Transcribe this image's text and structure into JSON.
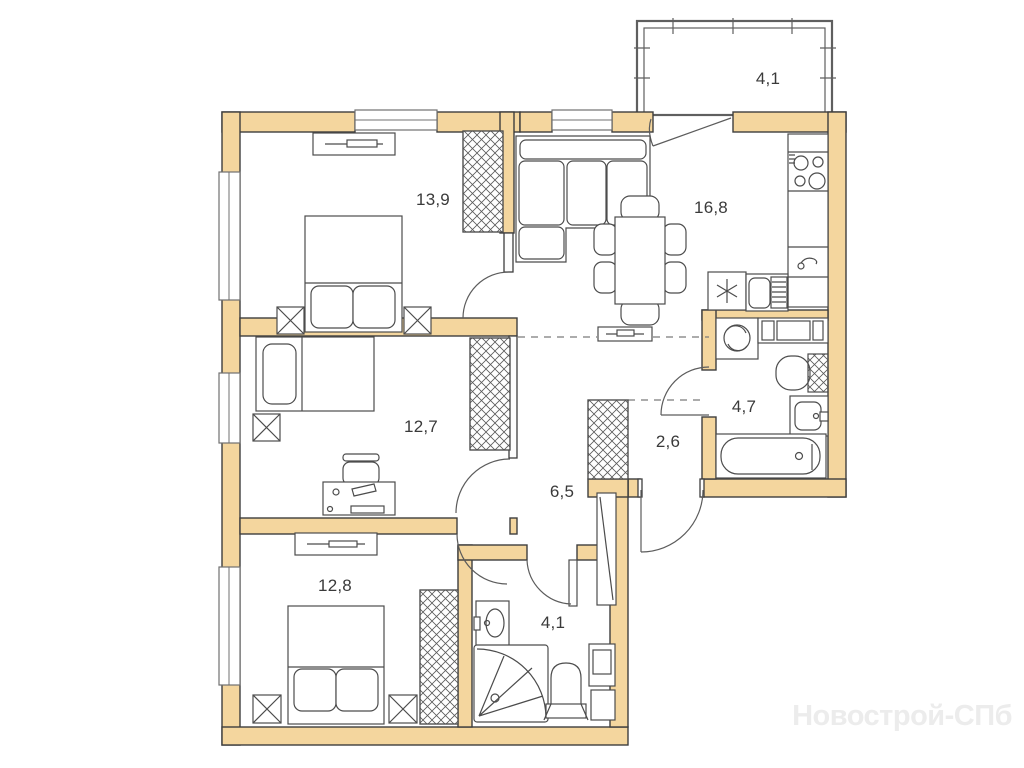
{
  "plan": {
    "type": "apartment-floor-plan",
    "watermark": "Новострой-СПб",
    "rooms": [
      {
        "name": "bedroom-top",
        "area": "13,9"
      },
      {
        "name": "kitchen-living",
        "area": "16,8"
      },
      {
        "name": "balcony",
        "area": "4,1"
      },
      {
        "name": "bedroom-middle",
        "area": "12,7"
      },
      {
        "name": "hallway",
        "area": "6,5"
      },
      {
        "name": "corridor",
        "area": "2,6"
      },
      {
        "name": "bathroom",
        "area": "4,7"
      },
      {
        "name": "bedroom-bottom",
        "area": "12,8"
      },
      {
        "name": "shower-room",
        "area": "4,1"
      }
    ],
    "colors": {
      "wall_fill": "#f4d69e",
      "wall_stroke": "#3e3e3e",
      "furniture_line": "#4c4c4c",
      "window_line": "#707070",
      "zone_dashed_line": "#7a7a7a",
      "watermark_text": "#ececec",
      "background": "#ffffff"
    }
  }
}
